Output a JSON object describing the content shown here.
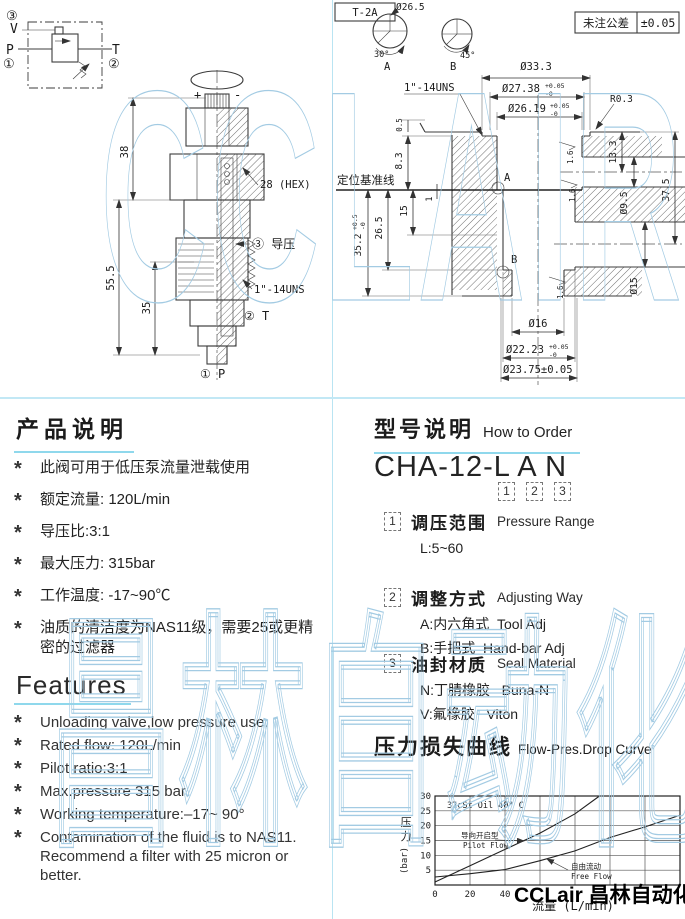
{
  "watermarks": {
    "top": "CCLAIR",
    "bottom": "昌林自动化"
  },
  "schematic": {
    "n3": "③",
    "v": "V",
    "p": "P",
    "n1": "①",
    "t": "T",
    "n2": "②"
  },
  "left_drawing": {
    "plus": "+",
    "minus": "-",
    "d38": "38",
    "d55_5": "55.5",
    "d35": "35",
    "hex": "28 (HEX)",
    "pilot": "③ 导压",
    "thread": "1\"-14UNS",
    "t_port": "② T",
    "p_port": "① P"
  },
  "right_drawing": {
    "tag": "T-2A",
    "tol_label": "未注公差",
    "tol_value": "±0.05",
    "detail_a_dia": "Ø26.5",
    "detail_a_angle": "30°",
    "detail_a": "A",
    "detail_b_angle": "45°",
    "detail_b": "B",
    "thread": "1\"-14UNS",
    "datum": "定位基准线",
    "d33_3": "Ø33.3",
    "d27_38": "Ø27.38",
    "d27_38_sup": "+0.05",
    "d27_38_sub": "-0",
    "d26_19": "Ø26.19",
    "d26_19_sup": "+0.05",
    "d26_19_sub": "-0",
    "r0_3": "R0.3",
    "d13_3": "13.3",
    "d37_5": "37.5",
    "d9_5": "Ø9.5",
    "d15_dia": "Ø15",
    "d35_2": "35.2",
    "d35_2_sup": "+0.5",
    "d35_2_sub": "-0",
    "d26_5": "26.5",
    "d15": "15",
    "d1": "1",
    "d8_3": "8.3",
    "d0_5": "0.5",
    "fin": "1.6",
    "a_mark": "A",
    "b_mark": "B",
    "d16": "Ø16",
    "d22_23": "Ø22.23",
    "d22_23_sup": "+0.05",
    "d22_23_sub": "-0",
    "d23_75": "Ø23.75±0.05"
  },
  "product": {
    "title": "产品说明",
    "marker": "*",
    "bullets": [
      "此阀可用于低压泵流量泄载使用",
      "额定流量: 120L/min",
      "导压比:3:1",
      "最大压力: 315bar",
      "工作温度: -17~90℃",
      "油质的清洁度为NAS11级，需要25或更精密的过滤器"
    ]
  },
  "features": {
    "title": "Features",
    "marker": "*",
    "bullets": [
      "Unloading valve,low pressure use.",
      "Rated flow: 120L/min",
      "Pilot ratio:3:1",
      "Max.pressure 315 bar",
      "Working temperature:–17~ 90°",
      "Contamination  of the fluid is to NAS11.  Recommend a filter with 25 micron or better."
    ]
  },
  "order": {
    "title": "型号说明",
    "subtitle": "How to Order",
    "model": "CHA-12-L A N",
    "digits": [
      "1",
      "2",
      "3"
    ],
    "items": [
      {
        "num": "1",
        "cn": "调压范围",
        "en": "Pressure Range",
        "line1": "L:5~60",
        "line2": ""
      },
      {
        "num": "2",
        "cn": "调整方式",
        "en": "Adjusting Way",
        "line1": "A:内六角式  Tool Adj",
        "line2": "B:手把式  Hand-bar Adj"
      },
      {
        "num": "3",
        "cn": "油封材质",
        "en": "Seal Material",
        "line1": "N:丁腈橡胶   Buna-N",
        "line2": "V:氟橡胶   Viton"
      }
    ]
  },
  "curve_section": {
    "title": "压力损失曲线",
    "subtitle": "Flow-Pres.Drop Curve"
  },
  "chart_data": {
    "type": "line",
    "inside_title": "32cSt Oil 40° C",
    "xlabel": "流量 (L/min)",
    "ylabel_cn": "压力",
    "ylabel_unit": "(bar)",
    "xlim": [
      0,
      140
    ],
    "ylim": [
      0,
      30
    ],
    "x_gridlines": [
      0,
      20,
      40,
      60,
      80,
      100,
      120,
      140
    ],
    "x_tick_labels": [
      0,
      20,
      40
    ],
    "y_ticks": [
      5,
      10,
      15,
      20,
      25,
      30
    ],
    "grid": true,
    "legend": "inline-labels",
    "series": [
      {
        "name_cn": "导向开启型",
        "name_en": "Pilot Flow",
        "points": [
          [
            0,
            1
          ],
          [
            20,
            6.5
          ],
          [
            40,
            12
          ],
          [
            60,
            17.5
          ],
          [
            80,
            24
          ],
          [
            94,
            30
          ]
        ]
      },
      {
        "name_cn": "自由流动",
        "name_en": "Free Flow",
        "points": [
          [
            0,
            2.7
          ],
          [
            20,
            3.8
          ],
          [
            40,
            5.2
          ],
          [
            60,
            8.2
          ],
          [
            80,
            11.5
          ],
          [
            100,
            16
          ],
          [
            120,
            19.6
          ],
          [
            140,
            23.5
          ]
        ]
      }
    ]
  },
  "footer": {
    "brand": "CCLair 昌林自动化"
  }
}
